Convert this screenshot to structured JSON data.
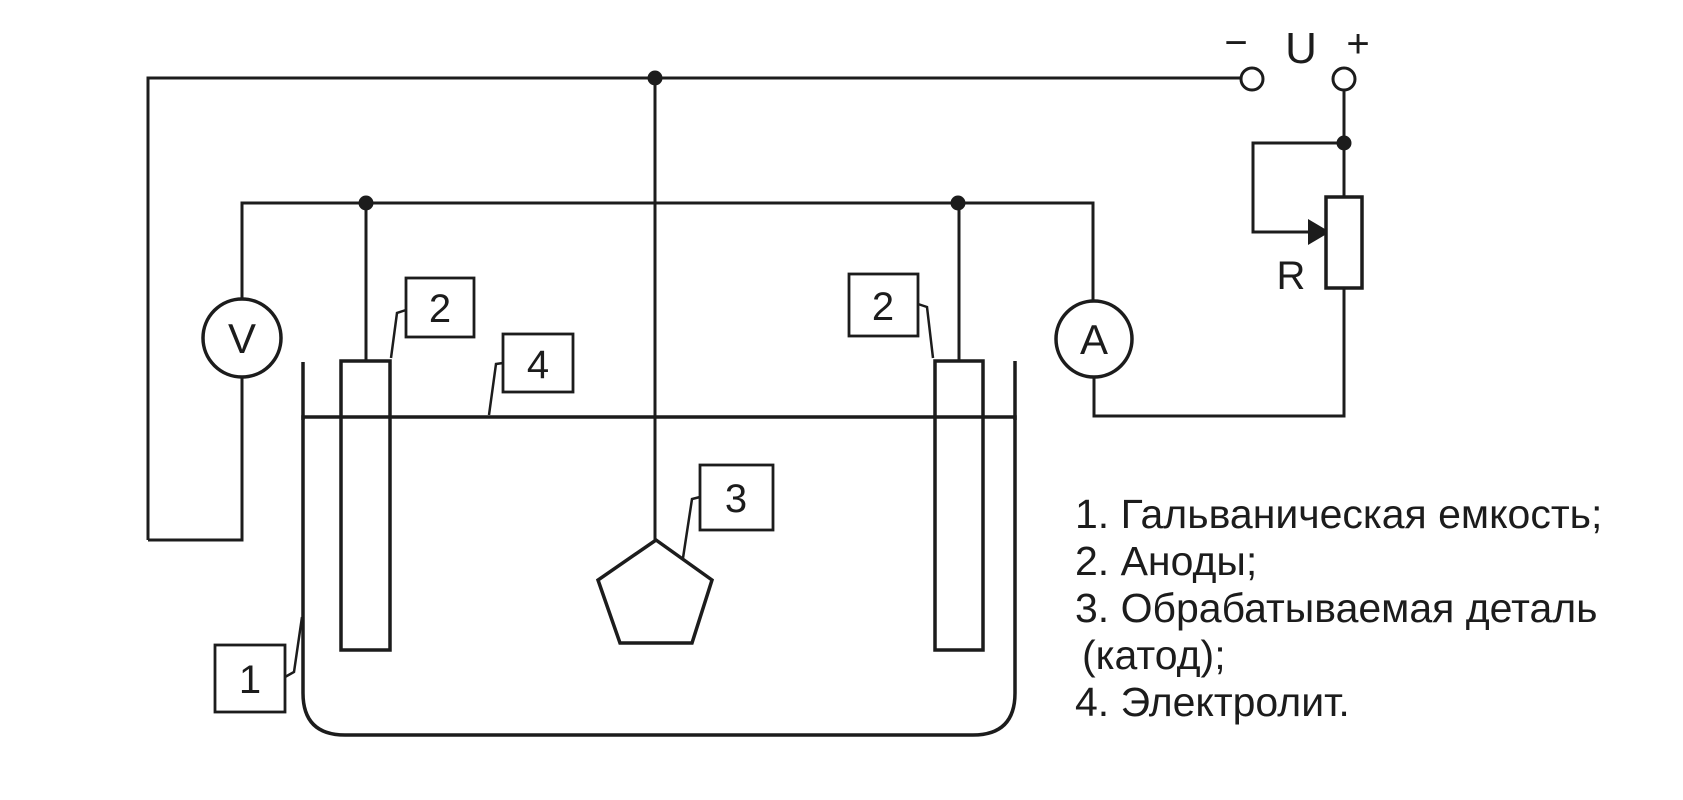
{
  "supply": {
    "minus_label": "−",
    "voltage_label": "U",
    "plus_label": "+"
  },
  "rheostat": {
    "label": "R"
  },
  "meters": {
    "voltmeter_label": "V",
    "ammeter_label": "A"
  },
  "callouts": {
    "tank": "1",
    "anodes": "2",
    "workpiece": "3",
    "electrolyte": "4"
  },
  "legend": {
    "lines": [
      "1. Гальваническая емкость;",
      "2. Аноды;",
      "3. Обрабатываемая деталь",
      "(катод);",
      "4. Электролит."
    ]
  },
  "colors": {
    "electrolyte": "#92d2a8",
    "anode": "#5d564b",
    "workpiece": "#c05f4a",
    "line": "#1c1c1c",
    "background": "#ffffff"
  }
}
